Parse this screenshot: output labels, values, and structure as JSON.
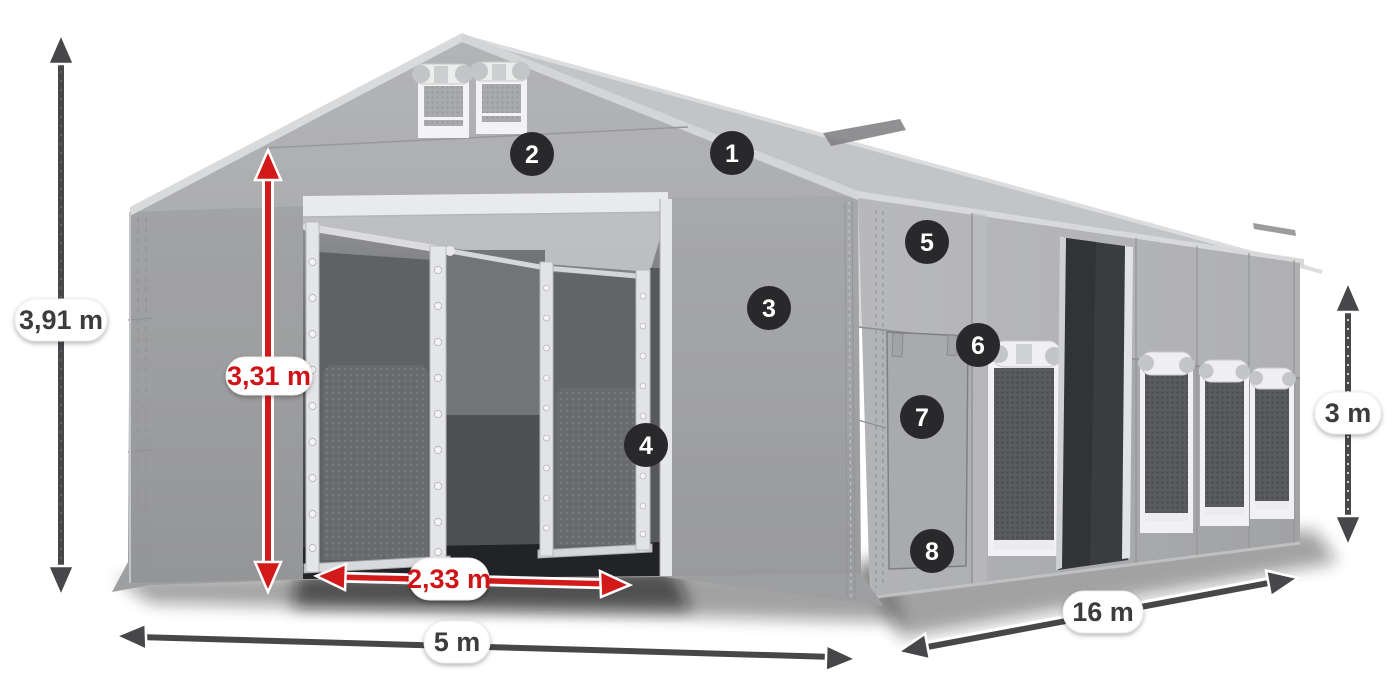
{
  "diagram": {
    "title": "storage-tent-product-diagram",
    "background_color": "#ffffff",
    "accent_red": "#d31a1a",
    "arrow_gray": "#47474a",
    "label_text_dark": "#3c3c3e",
    "callouts": [
      {
        "number": "1"
      },
      {
        "number": "2"
      },
      {
        "number": "3"
      },
      {
        "number": "4"
      },
      {
        "number": "5"
      },
      {
        "number": "6"
      },
      {
        "number": "7"
      },
      {
        "number": "8"
      }
    ],
    "dimensions": {
      "total_height": {
        "label": "3,91 m",
        "color": "gray"
      },
      "entrance_height": {
        "label": "3,31 m",
        "color": "red"
      },
      "entrance_width": {
        "label": "2,33 m",
        "color": "red"
      },
      "width": {
        "label": "5 m",
        "color": "gray"
      },
      "length": {
        "label": "16 m",
        "color": "gray"
      },
      "side_height": {
        "label": "3 m",
        "color": "gray"
      }
    }
  }
}
